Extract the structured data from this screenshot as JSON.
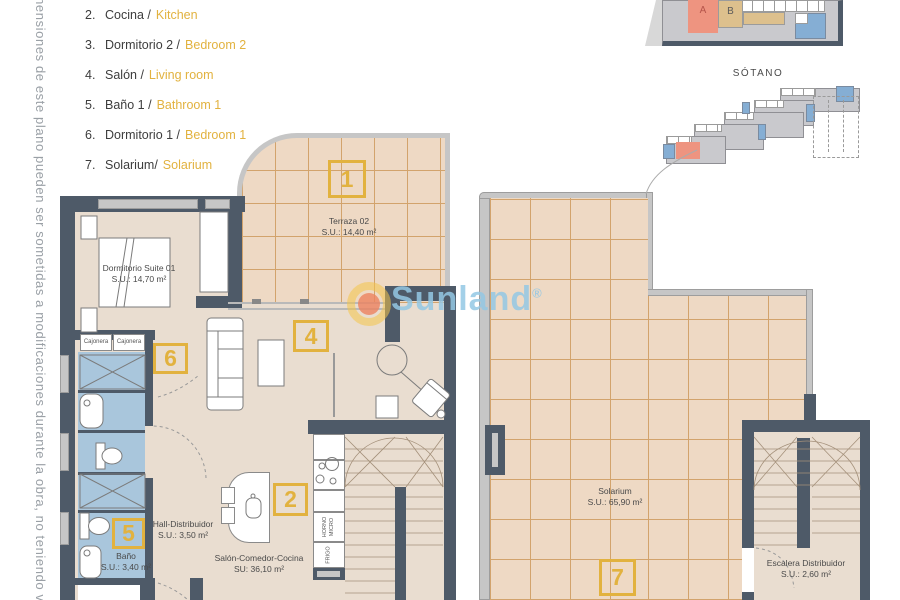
{
  "side_note": "imensiones de este plano pueden ser sometidas a modificaciones durante la obra, no teniendo v",
  "legend": {
    "items": [
      {
        "num": "2.",
        "es": "Cocina /",
        "en": "Kitchen"
      },
      {
        "num": "3.",
        "es": "Dormitorio 2 /",
        "en": "Bedroom 2"
      },
      {
        "num": "4.",
        "es": "Salón /",
        "en": "Living room"
      },
      {
        "num": "5.",
        "es": "Baño 1 /",
        "en": "Bathroom 1"
      },
      {
        "num": "6.",
        "es": "Dormitorio 1 /",
        "en": "Bedroom 1"
      },
      {
        "num": "7.",
        "es": "Solarium/",
        "en": "Solarium"
      }
    ]
  },
  "miniplans": {
    "sotano_label": "SÓTANO",
    "unit_a": "A",
    "unit_b": "B"
  },
  "watermark": {
    "brand": "Sunland",
    "reg": "®"
  },
  "plan": {
    "terraza": {
      "name": "Terraza 02",
      "area": "S.U.: 14,40 m²",
      "box": "1"
    },
    "dormitorio": {
      "name": "Dormitorio Suite 01",
      "area": "S.U.: 14,70 m²",
      "box": "6"
    },
    "cajonera_a": "Cajonera",
    "cajonera_b": "Cajonera",
    "salon": {
      "name": "Salón-Comedor-Cocina",
      "area": "SU: 36,10 m²",
      "box": "4"
    },
    "cocina": {
      "box": "2",
      "horno": "HORNO MICRO",
      "frigo": "FRIGO"
    },
    "hall": {
      "name": "Hall-Distribuidor",
      "area": "S.U.: 3,50 m²"
    },
    "bano": {
      "name": "Baño",
      "area": "S.U.: 3,40 m²",
      "box": "5"
    },
    "solarium": {
      "name": "Solarium",
      "area": "S.U.: 65,90 m²",
      "box": "7"
    },
    "escalera": {
      "name": "Escalera Distribuidor",
      "area": "S.U.: 2,60 m²"
    }
  },
  "colors": {
    "wall": "#4e5a68",
    "floor": "#e9ddd0",
    "tile_floor": "#eed9c4",
    "tile_line": "#d2a36c",
    "bath_blue": "#a9c6dc",
    "accent_yellow": "#e2b23f",
    "watermark_blue": "#94c8e4",
    "unit_a_salmon": "#ee9480",
    "unit_b_tan": "#ddc08d",
    "mini_blue": "#85aed4"
  }
}
